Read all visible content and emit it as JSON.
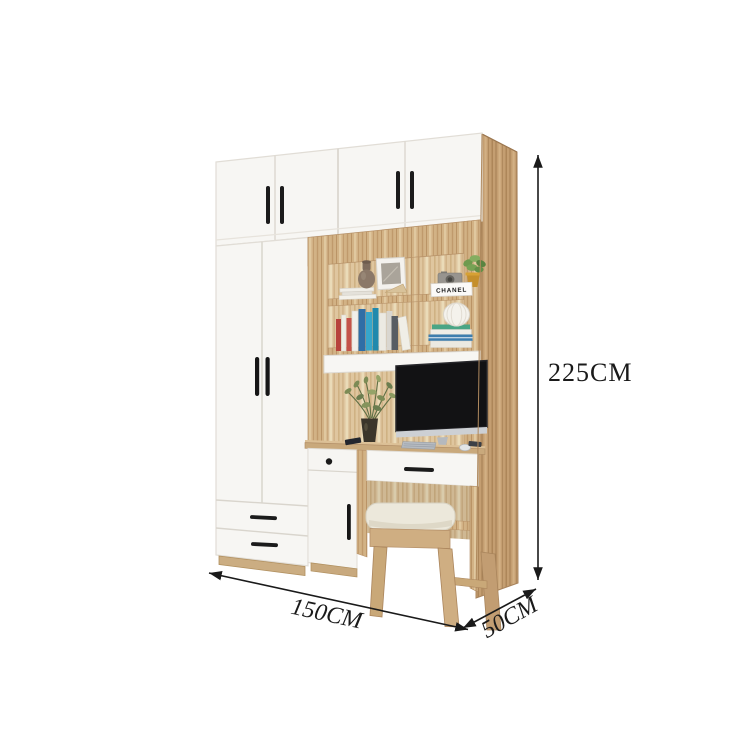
{
  "image": {
    "kind": "furniture-product-photo-with-dimensions",
    "background": "#ffffff",
    "subject": "wardrobe with integrated bookshelf, desk and stool"
  },
  "annotations": {
    "width_label": "150CM",
    "depth_label": "50CM",
    "height_label": "225CM"
  },
  "decor": {
    "chanel_box_label": "CHANEL"
  },
  "colors": {
    "dimension_ink": "#1a1a1a",
    "cabinet_white": "#f7f6f3",
    "wood_light": "#dfc69f",
    "wood_mid": "#d2b285",
    "wood_side": "#c49e71",
    "handle_black": "#1b1b1b",
    "monitor_screen": "#121214",
    "stool_cushion": "#ece8db"
  }
}
